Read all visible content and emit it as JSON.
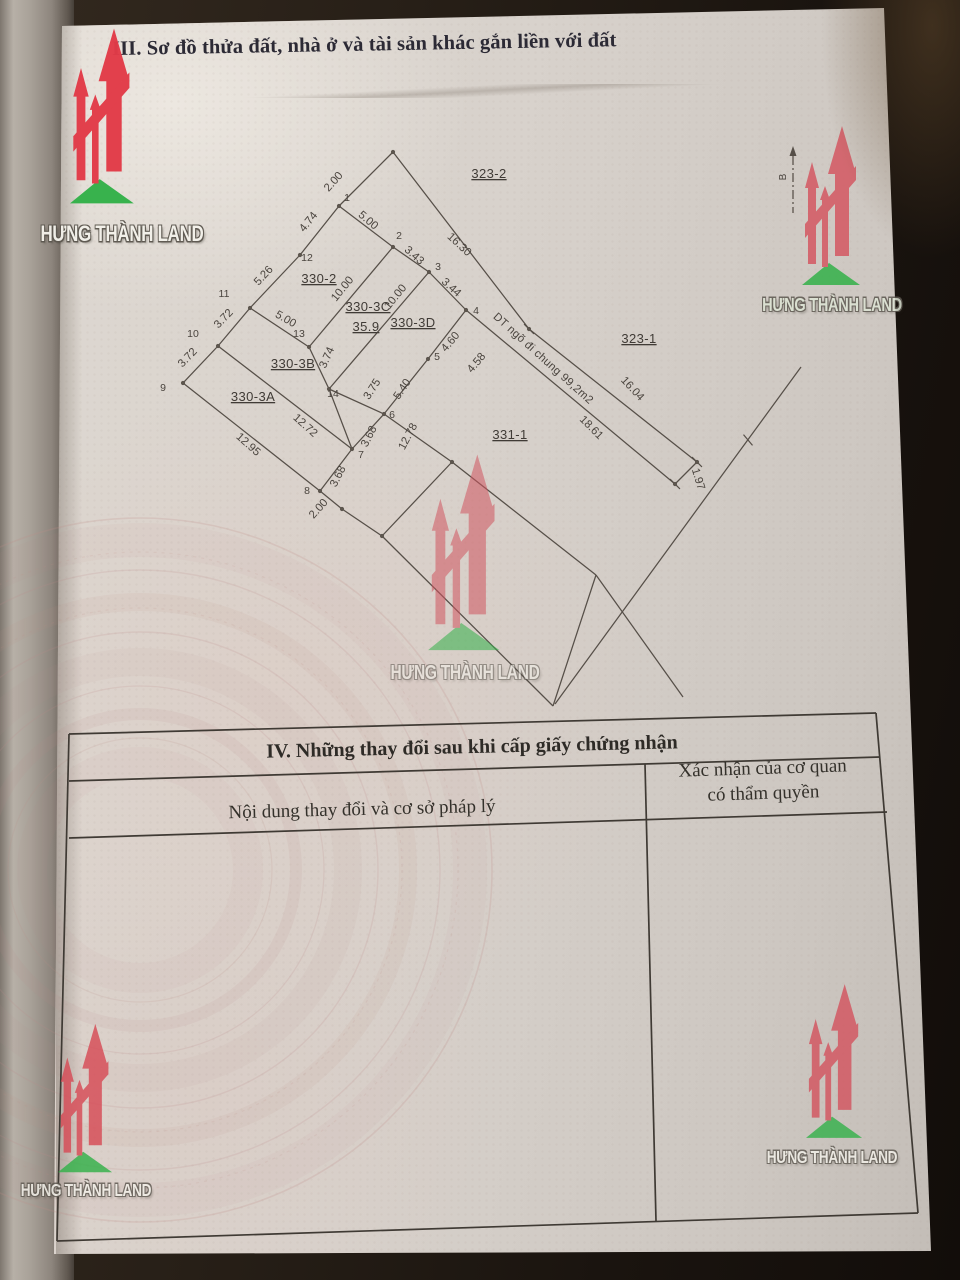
{
  "brand": {
    "name": "HƯNG THÀNH LAND",
    "red": "#d94f5a",
    "red_bright": "#e23b48",
    "green": "#33b149"
  },
  "header": {
    "section3_title": "III. Sơ đồ thửa đất, nhà ở và tài sản khác gắn liền với đất"
  },
  "section4": {
    "title": "IV. Những thay đổi sau khi cấp giấy chứng nhận",
    "col1_header": "Nội dung thay đổi và cơ sở pháp lý",
    "col2_header_line1": "Xác nhận của cơ quan",
    "col2_header_line2": "có thẩm quyền"
  },
  "compass": {
    "label": "B",
    "x": 793,
    "y1": 156,
    "y2": 213,
    "lx": 786,
    "ly": 177
  },
  "diagram": {
    "edges": [
      [
        393,
        152,
        339,
        206
      ],
      [
        339,
        206,
        393,
        247
      ],
      [
        393,
        247,
        429,
        272
      ],
      [
        429,
        272,
        466,
        310
      ],
      [
        466,
        310,
        428,
        359
      ],
      [
        428,
        359,
        384,
        414
      ],
      [
        384,
        414,
        352,
        449
      ],
      [
        352,
        449,
        320,
        491
      ],
      [
        320,
        491,
        342,
        509
      ],
      [
        339,
        206,
        300,
        255
      ],
      [
        300,
        255,
        250,
        308
      ],
      [
        250,
        308,
        218,
        346
      ],
      [
        218,
        346,
        183,
        383
      ],
      [
        183,
        383,
        320,
        491
      ],
      [
        218,
        346,
        352,
        449
      ],
      [
        250,
        308,
        309,
        347
      ],
      [
        393,
        247,
        309,
        347
      ],
      [
        429,
        272,
        329,
        389
      ],
      [
        309,
        347,
        329,
        389
      ],
      [
        329,
        389,
        384,
        414
      ],
      [
        329,
        389,
        352,
        449
      ],
      [
        393,
        152,
        529,
        329
      ],
      [
        529,
        329,
        697,
        462
      ],
      [
        466,
        310,
        675,
        484
      ],
      [
        697,
        462,
        675,
        484
      ],
      [
        384,
        414,
        452,
        462
      ],
      [
        452,
        462,
        596,
        575
      ],
      [
        452,
        462,
        382,
        536
      ],
      [
        342,
        509,
        382,
        536
      ],
      [
        382,
        536,
        553,
        706
      ],
      [
        596,
        575,
        553,
        706
      ],
      [
        801,
        367,
        555,
        704
      ],
      [
        596,
        575,
        683,
        697
      ]
    ],
    "ticks": [
      {
        "x": 529,
        "y": 329,
        "r": 45
      },
      {
        "x": 697,
        "y": 462,
        "r": 45
      },
      {
        "x": 675,
        "y": 484,
        "r": 45
      },
      {
        "x": 748,
        "y": 440,
        "r": 50
      }
    ],
    "dots": [
      [
        393,
        152
      ],
      [
        339,
        206
      ],
      [
        393,
        247
      ],
      [
        429,
        272
      ],
      [
        466,
        310
      ],
      [
        428,
        359
      ],
      [
        384,
        414
      ],
      [
        352,
        449
      ],
      [
        320,
        491
      ],
      [
        342,
        509
      ],
      [
        183,
        383
      ],
      [
        218,
        346
      ],
      [
        250,
        308
      ],
      [
        300,
        255
      ],
      [
        309,
        347
      ],
      [
        329,
        389
      ],
      [
        452,
        462
      ],
      [
        382,
        536
      ],
      [
        529,
        329
      ],
      [
        697,
        462
      ],
      [
        675,
        484
      ]
    ],
    "dimensions": [
      {
        "t": "2.00",
        "x": 336,
        "y": 184,
        "r": -48
      },
      {
        "t": "5.00",
        "x": 366,
        "y": 223,
        "r": 40
      },
      {
        "t": "3.43",
        "x": 412,
        "y": 258,
        "r": 41
      },
      {
        "t": "3.44",
        "x": 449,
        "y": 290,
        "r": 42
      },
      {
        "t": "16.30",
        "x": 457,
        "y": 247,
        "r": 43
      },
      {
        "t": "4.74",
        "x": 311,
        "y": 224,
        "r": -51
      },
      {
        "t": "5.26",
        "x": 266,
        "y": 278,
        "r": -47
      },
      {
        "t": "3.72",
        "x": 226,
        "y": 321,
        "r": -46
      },
      {
        "t": "3.72",
        "x": 190,
        "y": 360,
        "r": -46
      },
      {
        "t": "10.00",
        "x": 345,
        "y": 291,
        "r": -51
      },
      {
        "t": "10.00",
        "x": 398,
        "y": 299,
        "r": -51
      },
      {
        "t": "5.00",
        "x": 284,
        "y": 322,
        "r": 30
      },
      {
        "t": "3.74",
        "x": 330,
        "y": 359,
        "r": -66
      },
      {
        "t": "3.75",
        "x": 375,
        "y": 391,
        "r": -57
      },
      {
        "t": "12.72",
        "x": 303,
        "y": 428,
        "r": 42
      },
      {
        "t": "12.95",
        "x": 246,
        "y": 447,
        "r": 42
      },
      {
        "t": "4.60",
        "x": 453,
        "y": 344,
        "r": -50
      },
      {
        "t": "4.58",
        "x": 479,
        "y": 365,
        "r": -50
      },
      {
        "t": "5.40",
        "x": 405,
        "y": 391,
        "r": -56
      },
      {
        "t": "3.68",
        "x": 372,
        "y": 438,
        "r": -63
      },
      {
        "t": "3.68",
        "x": 341,
        "y": 478,
        "r": -63
      },
      {
        "t": "2.00",
        "x": 321,
        "y": 511,
        "r": -48
      },
      {
        "t": "12.78",
        "x": 411,
        "y": 438,
        "r": -62
      },
      {
        "t": "16.04",
        "x": 630,
        "y": 391,
        "r": 47
      },
      {
        "t": "18.61",
        "x": 589,
        "y": 430,
        "r": 45
      },
      {
        "t": "1.97",
        "x": 695,
        "y": 480,
        "r": 73
      }
    ],
    "vertex_labels": [
      {
        "t": "1",
        "x": 347,
        "y": 201
      },
      {
        "t": "2",
        "x": 399,
        "y": 239
      },
      {
        "t": "3",
        "x": 438,
        "y": 270
      },
      {
        "t": "4",
        "x": 476,
        "y": 314
      },
      {
        "t": "5",
        "x": 437,
        "y": 360
      },
      {
        "t": "6",
        "x": 392,
        "y": 418
      },
      {
        "t": "7",
        "x": 361,
        "y": 458
      },
      {
        "t": "8",
        "x": 307,
        "y": 494
      },
      {
        "t": "9",
        "x": 163,
        "y": 391
      },
      {
        "t": "10",
        "x": 193,
        "y": 337
      },
      {
        "t": "11",
        "x": 224,
        "y": 297
      },
      {
        "t": "12",
        "x": 307,
        "y": 261
      },
      {
        "t": "13",
        "x": 299,
        "y": 337
      },
      {
        "t": "14",
        "x": 333,
        "y": 397
      }
    ],
    "parcel_labels": [
      {
        "t": "323-2",
        "x": 489,
        "y": 178
      },
      {
        "t": "330-2",
        "x": 319,
        "y": 283
      },
      {
        "t": "330-3C",
        "x": 368,
        "y": 311
      },
      {
        "t": "35.9",
        "x": 366,
        "y": 331
      },
      {
        "t": "330-3D",
        "x": 413,
        "y": 327
      },
      {
        "t": "330-3B",
        "x": 293,
        "y": 368
      },
      {
        "t": "330-3A",
        "x": 253,
        "y": 401
      },
      {
        "t": "323-1",
        "x": 639,
        "y": 343
      },
      {
        "t": "331-1",
        "x": 510,
        "y": 439
      }
    ],
    "note": {
      "t": "DT ngõ đi chung 99,2m2",
      "x": 541,
      "y": 361,
      "r": 42
    }
  },
  "table_lines": [
    [
      69,
      734,
      876,
      713
    ],
    [
      69,
      781,
      880,
      757
    ],
    [
      69,
      838,
      887,
      812
    ],
    [
      57,
      1241,
      918,
      1213
    ],
    [
      69,
      734,
      57,
      1241
    ],
    [
      876,
      713,
      918,
      1213
    ],
    [
      645,
      764,
      656,
      1221
    ]
  ]
}
